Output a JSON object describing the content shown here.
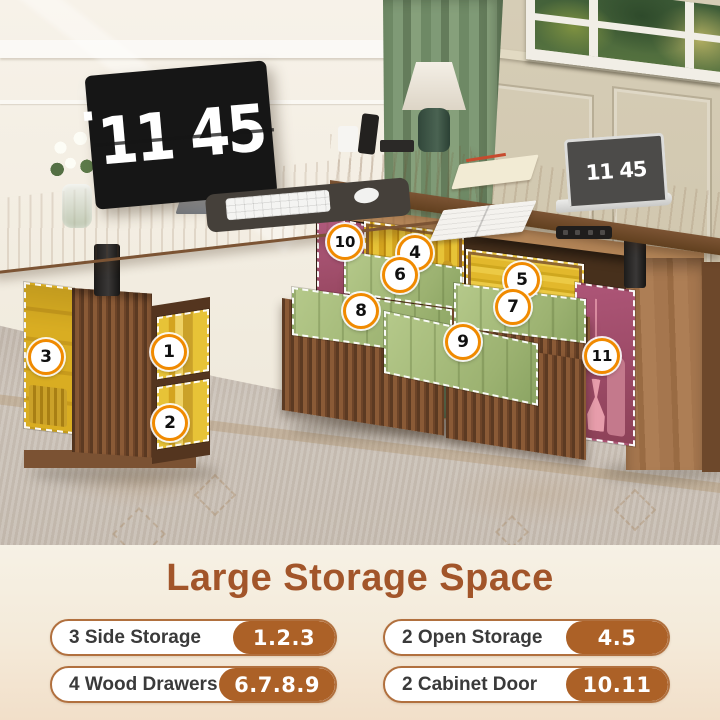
{
  "scene": {
    "monitor_clock": "11 45",
    "laptop_clock": "11 45",
    "callouts": [
      {
        "n": "1"
      },
      {
        "n": "2"
      },
      {
        "n": "3"
      },
      {
        "n": "4"
      },
      {
        "n": "5"
      },
      {
        "n": "6"
      },
      {
        "n": "7"
      },
      {
        "n": "8"
      },
      {
        "n": "9"
      },
      {
        "n": "10"
      },
      {
        "n": "11"
      }
    ]
  },
  "panel": {
    "title": "Large Storage Space",
    "features": [
      {
        "label": "3 Side Storage",
        "value": "1.2.3"
      },
      {
        "label": "2 Open Storage",
        "value": "4.5"
      },
      {
        "label": "4 Wood Drawers",
        "value": "6.7.8.9"
      },
      {
        "label": "2 Cabinet Door",
        "value": "10.11"
      }
    ]
  },
  "colors": {
    "title_brown": "#a2552a",
    "pill_border": "#b1703e",
    "pill_badge_bg": "#ac6127",
    "callout_ring": "#f08a00",
    "highlight_yellow": "#e2b82c",
    "highlight_green": "#a9c07d",
    "highlight_magenta": "#a84f6f"
  }
}
